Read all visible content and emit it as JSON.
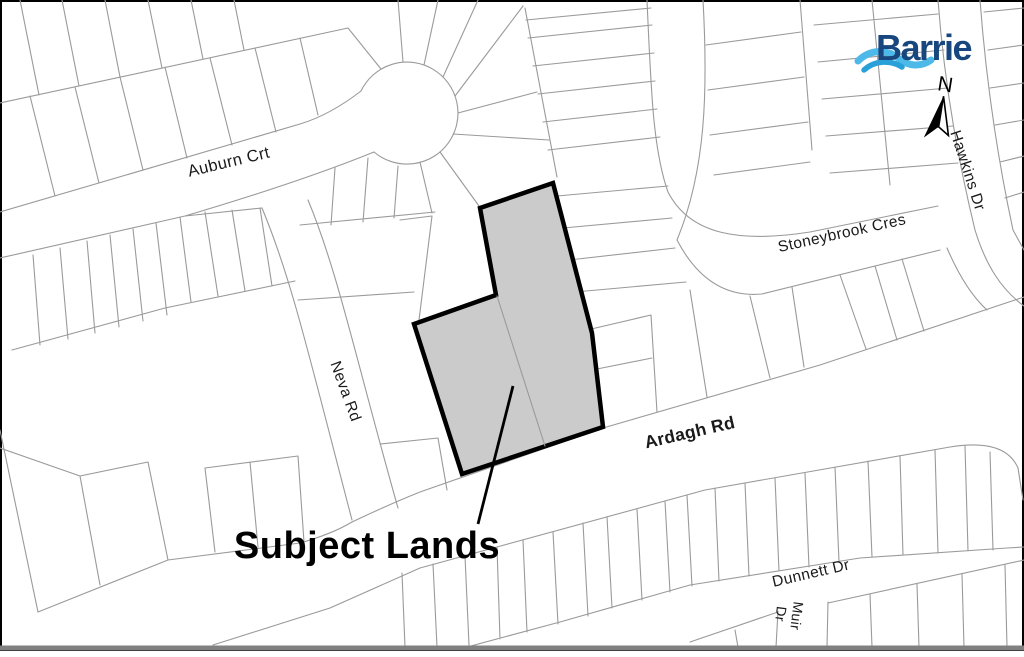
{
  "logo_text": "Barrie",
  "north_label": "N",
  "subject_lands_label": "Subject Lands",
  "streets": {
    "auburn": "Auburn Crt",
    "neva": "Neva Rd",
    "stoneybrook": "Stoneybrook Cres",
    "hawkins": "Hawkins Dr",
    "ardagh": "Ardagh Rd",
    "dunnett": "Dunnett Dr",
    "muir_line1": "Muir",
    "muir_line2": "Dr"
  },
  "colors": {
    "subject_fill": "#cbcbcb",
    "subject_outline": "#000000",
    "parcel_line": "#9a9a9a",
    "logo_dark_blue": "#17477e",
    "logo_light_blue": "#4db9e8",
    "logo_mid_blue": "#2aa0d8",
    "frame_bottom": "#808080"
  }
}
